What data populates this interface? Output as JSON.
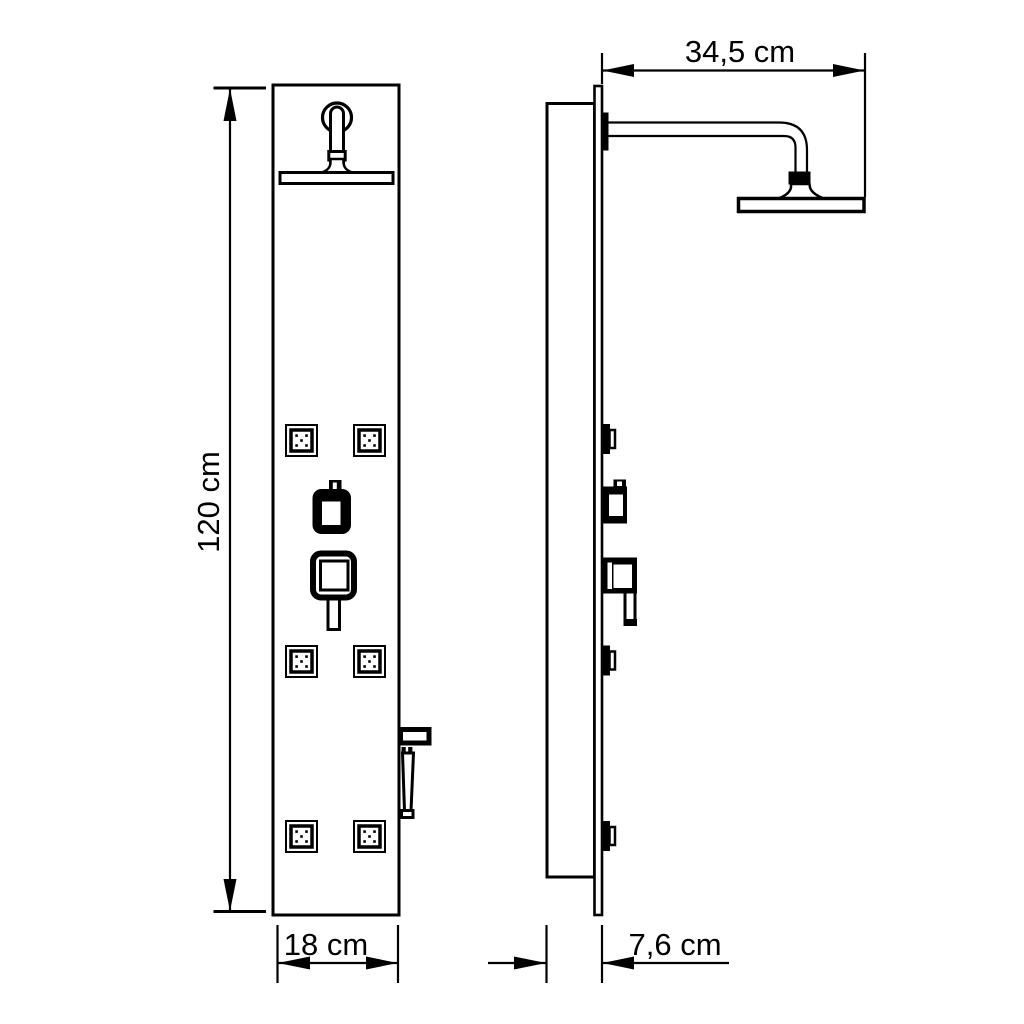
{
  "figure": {
    "type": "technical-line-drawing",
    "subject": "shower panel with overhead rain shower, body jets and hand shower",
    "background_color": "#ffffff",
    "line_color": "#000000"
  },
  "dimensions": {
    "height": "120 cm",
    "width": "18 cm",
    "arm_reach": "34,5 cm",
    "depth": "7,6 cm"
  },
  "views": {
    "front": {
      "name": "front-view",
      "components": [
        "wall-flange",
        "drop-pipe",
        "rain-shower-head",
        "body-jet x6",
        "diverter-knob",
        "mixer-handle",
        "hand-shower-holder",
        "hand-shower"
      ]
    },
    "side": {
      "name": "side-view",
      "components": [
        "panel-body-profile",
        "glass-front-plate",
        "arm-wall-flange",
        "shower-arm",
        "rain-shower-head",
        "body-jet x3",
        "diverter-knob",
        "mixer-handle"
      ]
    }
  }
}
